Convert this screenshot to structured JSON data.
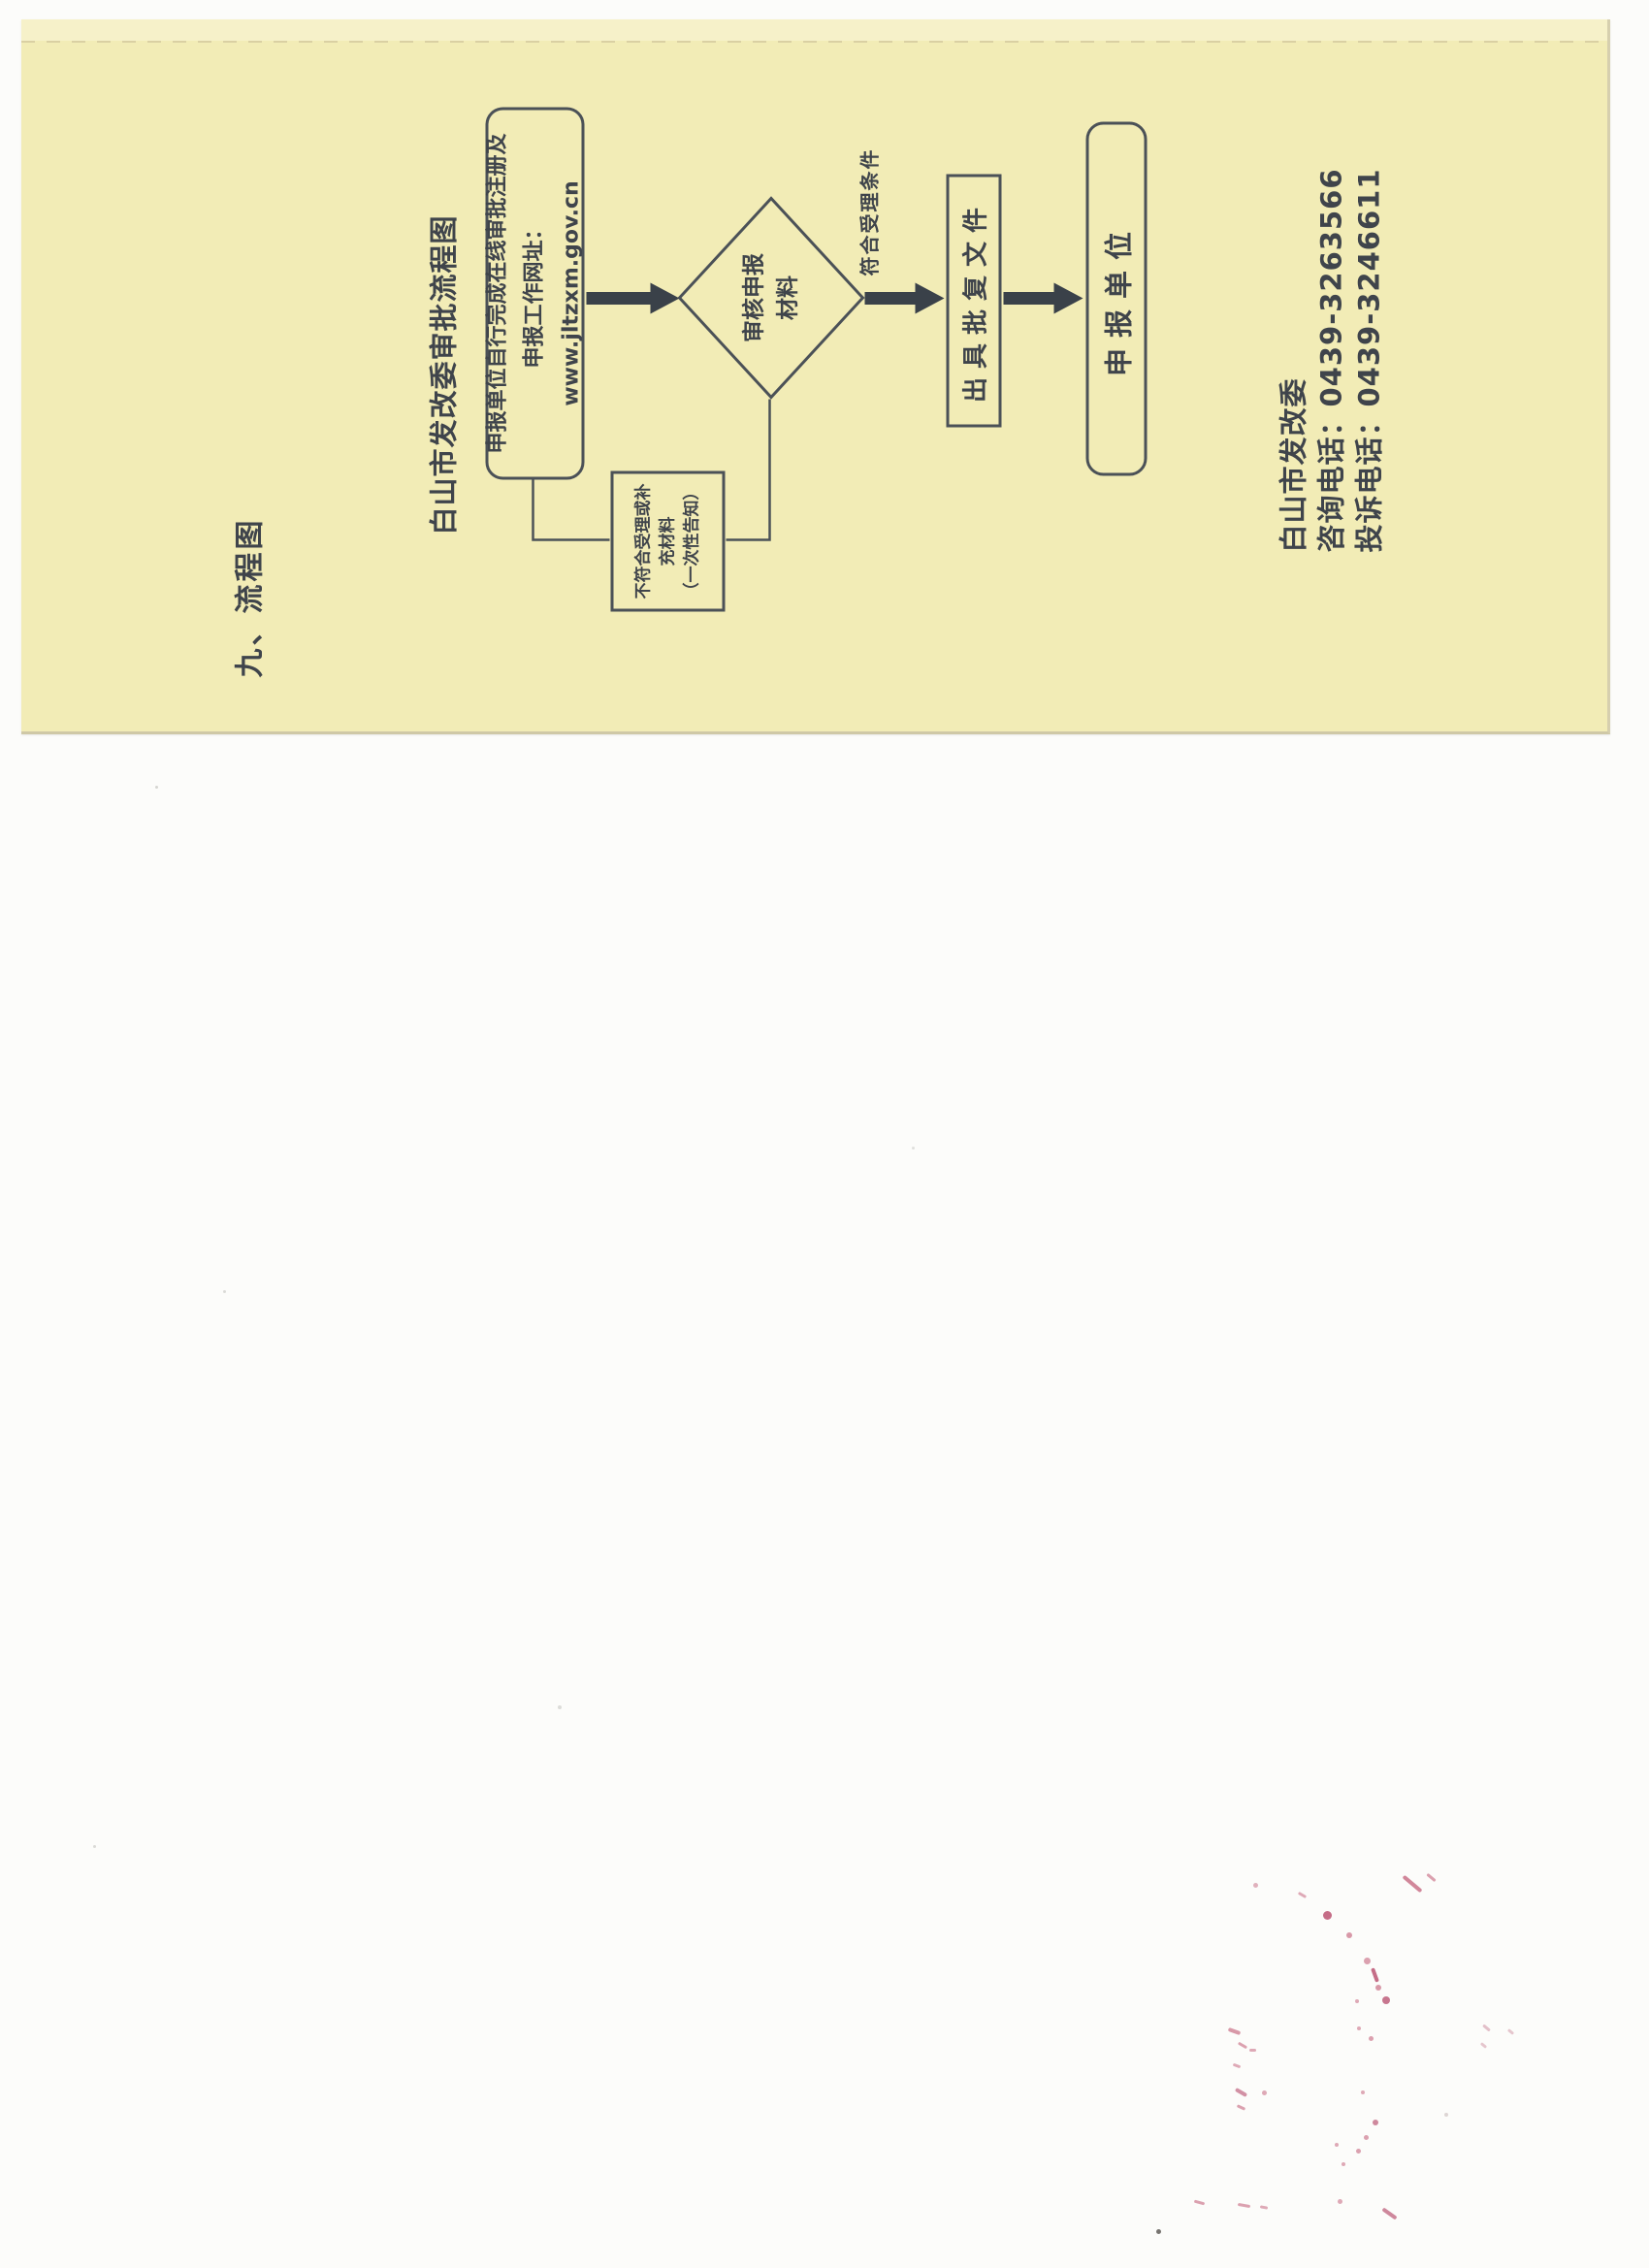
{
  "page": {
    "section_heading": "九、流程图",
    "title": "白山市发改委审批流程图",
    "flowchart": {
      "start_box": {
        "line1": "申报单位自行完成在线审批注册及",
        "line2": "申报工作网址：www.jltzxm.gov.cn"
      },
      "decision": {
        "line1": "审核申报",
        "line2": "材料"
      },
      "reject_box": {
        "line1": "不符合受理或补",
        "line2": "充材料",
        "line3": "（一次性告知）"
      },
      "condition_label": "符合受理条件",
      "approve_box": "出具批复文件",
      "end_box": "申报单位"
    },
    "contact": {
      "org": "白山市发改委",
      "consult": "咨询电话：0439-3263566",
      "complaint": "投诉电话：0439-3246611"
    },
    "colors": {
      "paper": "#f2ecb6",
      "paper_light": "#f6f1c9",
      "ink": "#3f444b",
      "line": "#4b5157",
      "stamp": "#bf5671"
    }
  }
}
